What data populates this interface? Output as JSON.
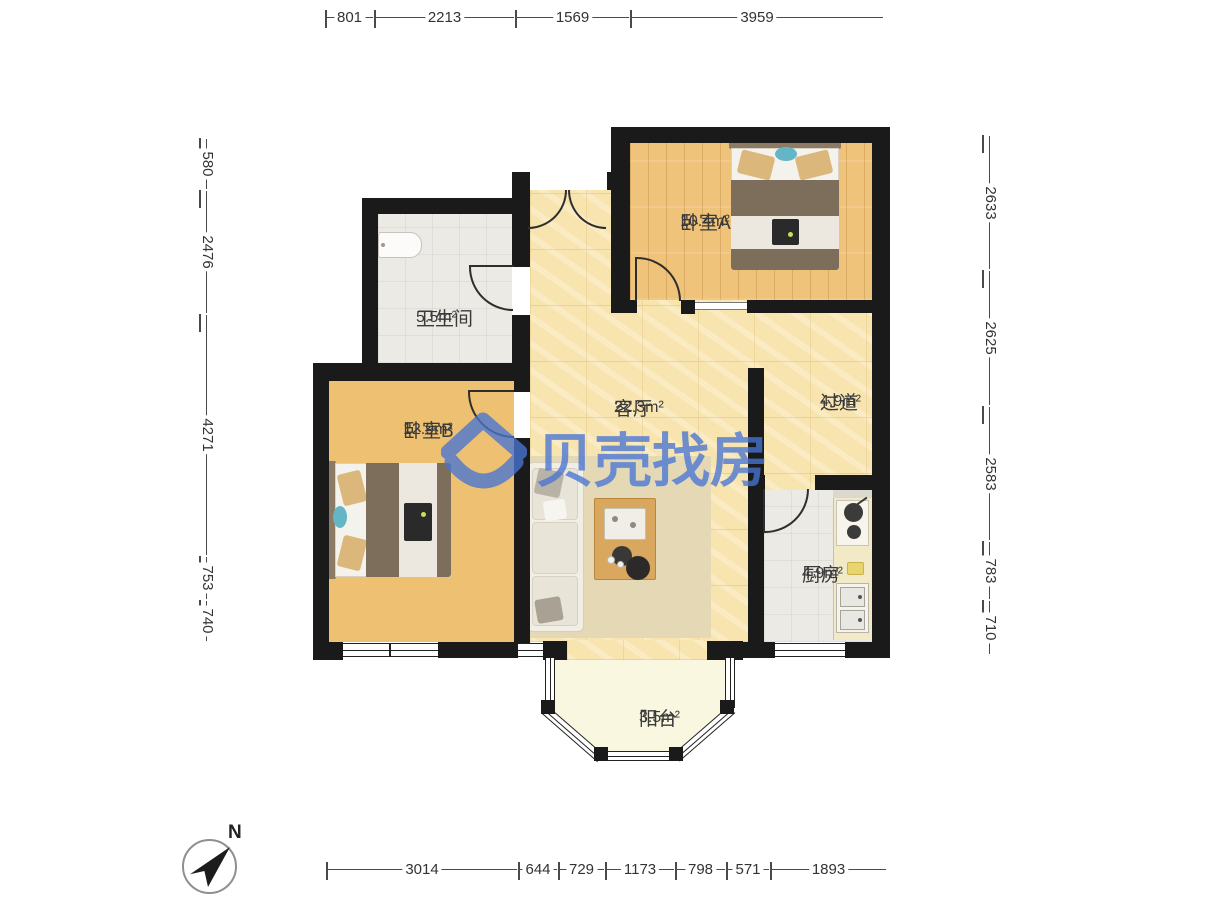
{
  "watermark": {
    "text": "贝壳找房",
    "color": "#4875D3"
  },
  "compass": {
    "north_label": "N"
  },
  "rooms": {
    "bedroomA": {
      "name": "卧室A",
      "area": "10.4m²"
    },
    "bathroom": {
      "name": "卫生间",
      "area": "5.5m²"
    },
    "bedroomB": {
      "name": "卧室B",
      "area": "12.9m²"
    },
    "living": {
      "name": "客厅",
      "area": "22.3m²"
    },
    "hallway": {
      "name": "过道",
      "area": "4.9m²"
    },
    "kitchen": {
      "name": "厨房",
      "area": "4.9m²"
    },
    "balcony": {
      "name": "阳台",
      "area": "3.5m²"
    }
  },
  "dimensions": {
    "top": [
      "801",
      "2213",
      "1569",
      "3959"
    ],
    "left": [
      "580",
      "2476",
      "4271",
      "753",
      "740"
    ],
    "right": [
      "2633",
      "2625",
      "2583",
      "783",
      "710"
    ],
    "bottom": [
      "3014",
      "644",
      "729",
      "1173",
      "798",
      "571",
      "1893"
    ]
  }
}
